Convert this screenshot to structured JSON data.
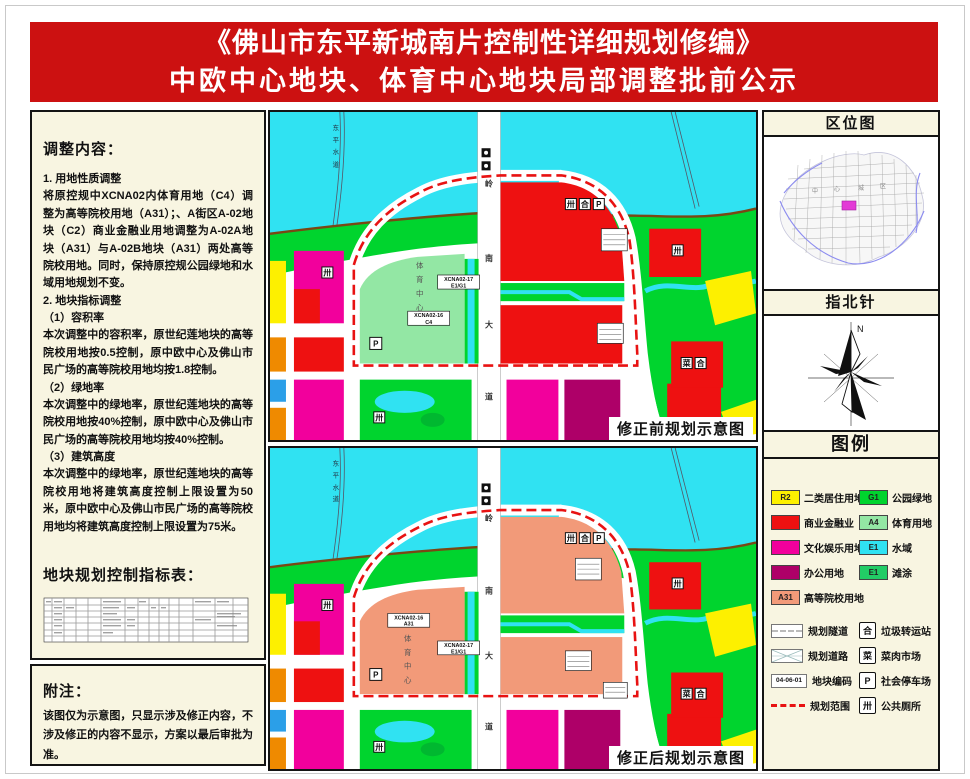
{
  "title": {
    "line1": "《佛山市东平新城南片控制性详细规划修编》",
    "line2": "中欧中心地块、体育中心地块局部调整批前公示"
  },
  "left": {
    "adjust_heading": "调整内容：",
    "p1": "1. 用地性质调整",
    "p2": "将原控规中XCNA02内体育用地（C4）调整为高等院校用地（A31）；、A街区A-02地块（C2）商业金融业用地调整为A-02A地块（A31）与A-02B地块（A31）两处高等院校用地。同时，保持原控规公园绿地和水域用地规划不变。",
    "p3": "2. 地块指标调整",
    "p4": "（1）容积率",
    "p5": "本次调整中的容积率，原世纪莲地块的高等院校用地按0.5控制，原中欧中心及佛山市民广场的高等院校用地均按1.8控制。",
    "p6": "（2）绿地率",
    "p7": "本次调整中的绿地率，原世纪莲地块的高等院校用地按40%控制，原中欧中心及佛山市民广场的高等院校用地均按40%控制。",
    "p8": "（3）建筑高度",
    "p9": "本次调整中的绿地率，原世纪莲地块的高等院校用地将建筑高度控制上限设置为50米，原中欧中心及佛山市民广场的高等院校用地均将建筑高度控制上限设置为75米。",
    "table_heading": "地块规划控制指标表：",
    "notes_heading": "附注：",
    "notes_body": "该图仅为示意图，只显示涉及修正内容，不涉及修正的内容不显示，方案以最后审批为准。"
  },
  "maps": {
    "before": {
      "caption": "修正前规划示意图",
      "code1_l1": "XCNA02-16",
      "code1_l2": "C4",
      "code2_l1": "XCNA02-17",
      "code2_l2": "E1/G1"
    },
    "after": {
      "caption": "修正后规划示意图",
      "code1_l1": "XCNA02-16",
      "code1_l2": "A31",
      "code2_l1": "XCNA02-17",
      "code2_l2": "E1/G1"
    },
    "center_label": [
      "体",
      "育",
      "中",
      "心"
    ],
    "road_label": [
      "岭",
      "南",
      "大",
      "道"
    ],
    "water_label": [
      "东",
      "平",
      "水",
      "道"
    ],
    "icons": {
      "parking": "P"
    }
  },
  "right": {
    "location_title": "区位图",
    "location_center_label": [
      "中",
      "心",
      "城",
      "区"
    ],
    "compass_title": "指北针",
    "north": "N",
    "legend_title": "图例",
    "land": [
      {
        "code": "R2",
        "label": "二类居住用地",
        "color": "#fdf000"
      },
      {
        "code": "",
        "label": "商业金融业",
        "color": "#ee1111"
      },
      {
        "code": "",
        "label": "文化娱乐用地",
        "color": "#f2009c"
      },
      {
        "code": "",
        "label": "办公用地",
        "color": "#ae0068"
      },
      {
        "code": "A31",
        "label": "高等院校用地",
        "color": "#f29a79"
      },
      {
        "code": "G1",
        "label": "公园绿地",
        "color": "#00d42e"
      },
      {
        "code": "A4",
        "label": "体育用地",
        "color": "#93e7a4"
      },
      {
        "code": "E1",
        "label": "水域",
        "color": "#30e2f2"
      },
      {
        "code": "E1",
        "label": "滩涂",
        "color": "#22cc66"
      }
    ],
    "symbols": {
      "tunnel": "规划隧道",
      "road": "规划道路",
      "code_text": "04-06-01",
      "code_label": "地块编码",
      "boundary": "规划范围",
      "garbage": "垃圾转运站",
      "market": "菜肉市场",
      "parking": "社会停车场",
      "toilet": "公共厕所",
      "garbage_glyph": "合",
      "market_glyph": "菜",
      "parking_glyph": "P",
      "toilet_glyph": "卅"
    }
  }
}
